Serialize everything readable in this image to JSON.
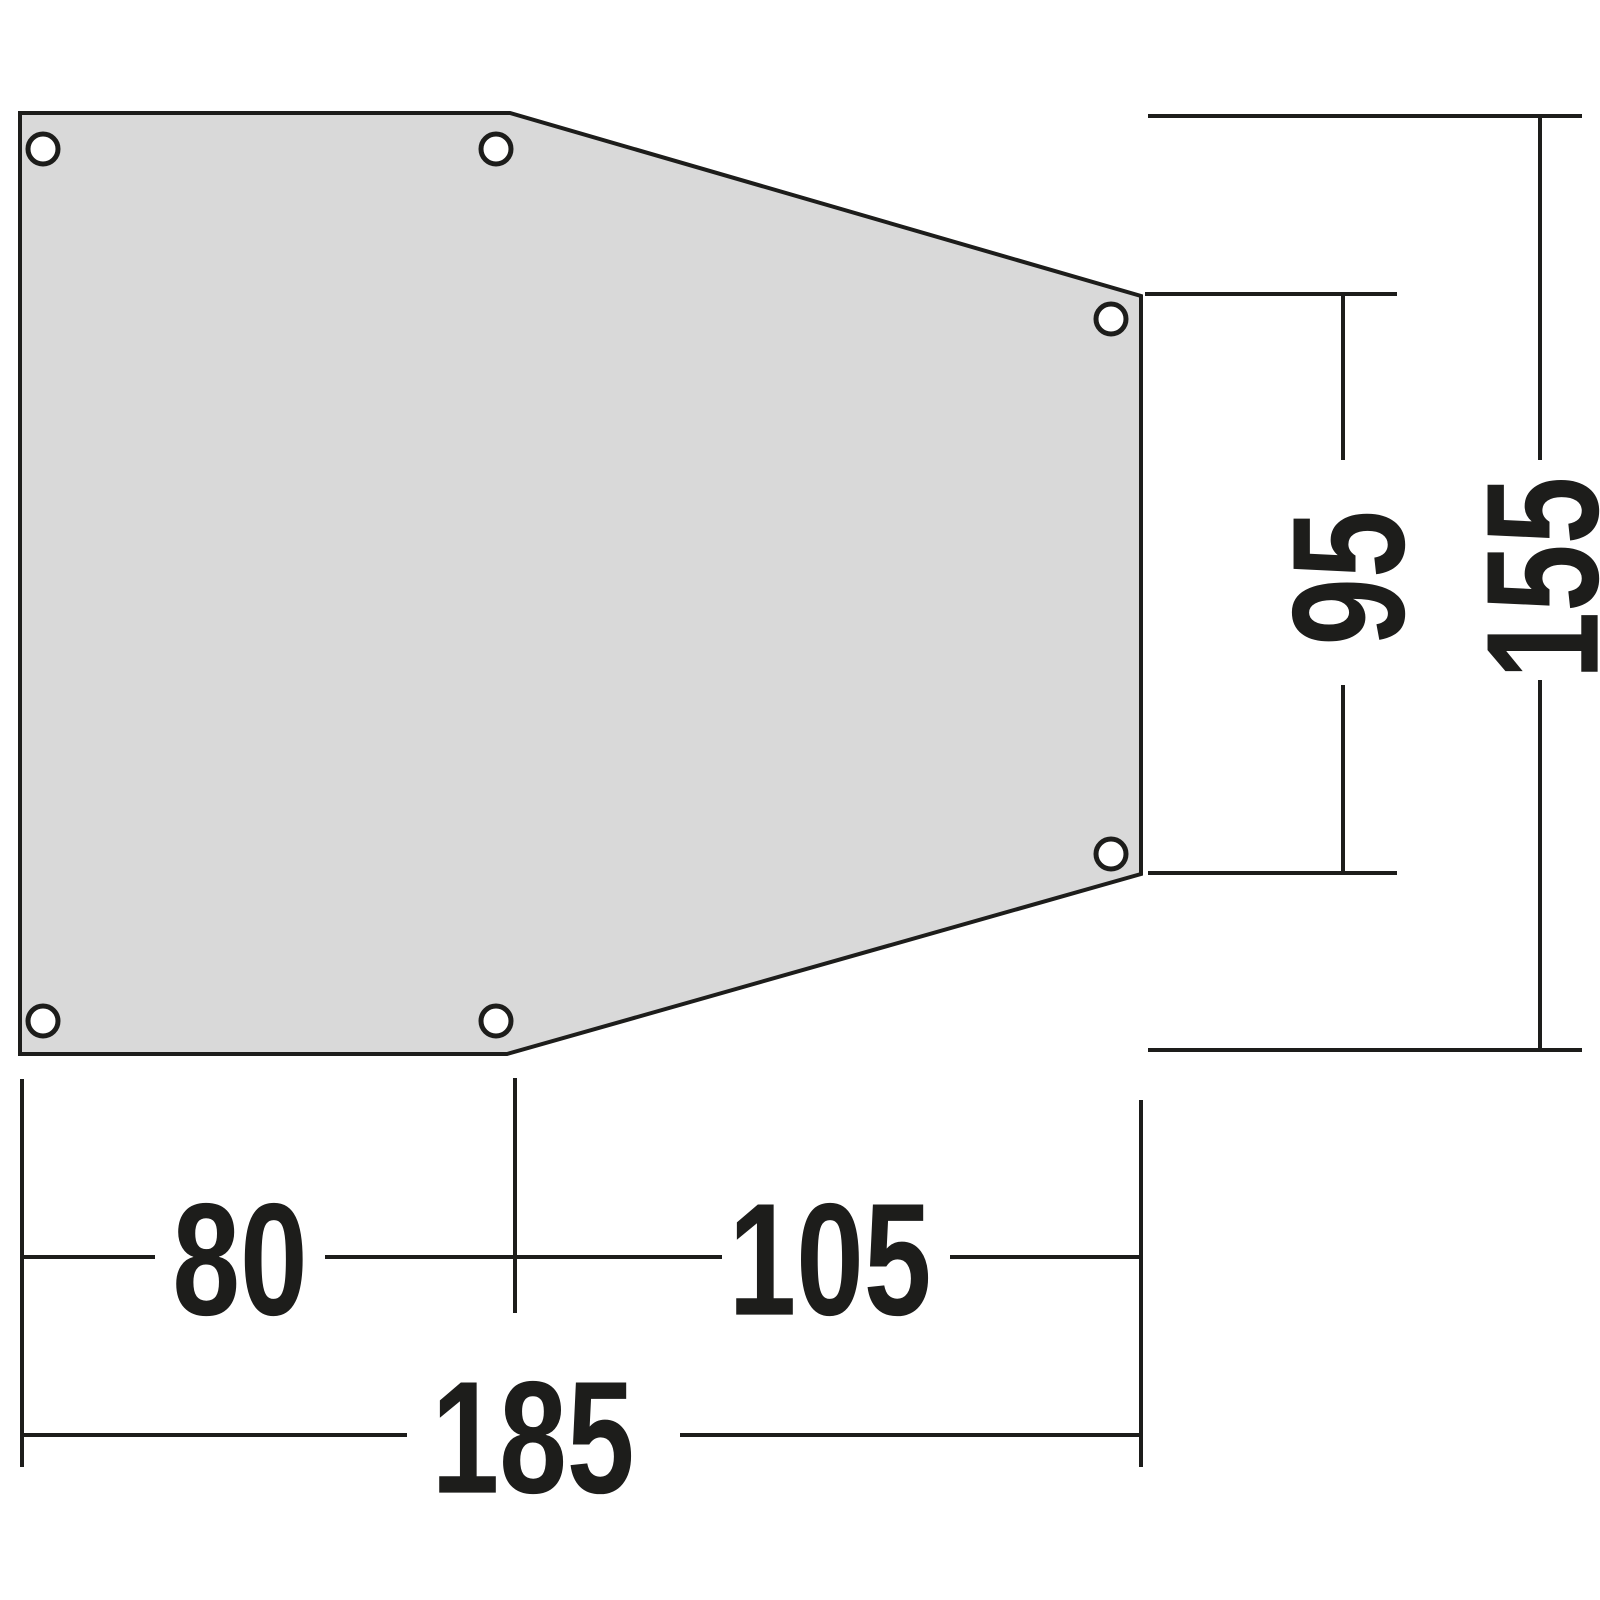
{
  "diagram": {
    "colors": {
      "shape_fill": "#d9d9d9",
      "line": "#1d1d1b",
      "background": "#ffffff"
    },
    "eyelets": {
      "count": 6,
      "style": "white circle with black ring"
    },
    "dimensions": {
      "width_left": "80",
      "width_right": "105",
      "width_total": "185",
      "height_inner_right": "95",
      "height_total": "155"
    }
  }
}
